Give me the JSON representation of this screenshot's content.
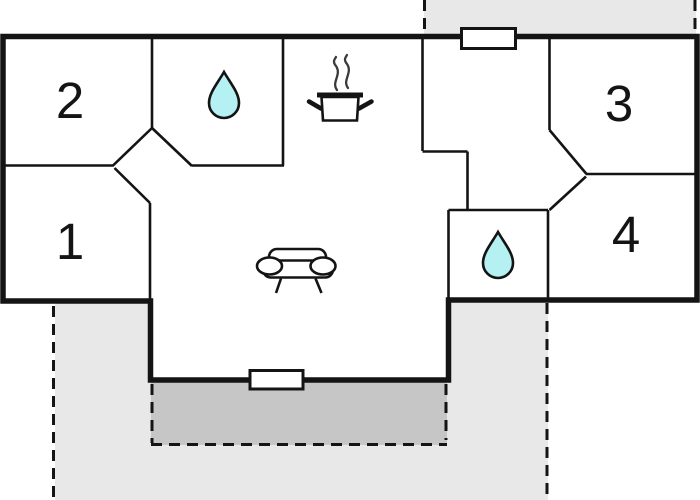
{
  "floor_plan": {
    "rooms": [
      {
        "label": "1"
      },
      {
        "label": "2"
      },
      {
        "label": "3"
      },
      {
        "label": "4"
      }
    ],
    "icons": {
      "bathroom_top": "water-drop-icon",
      "bathroom_bottom": "water-drop-icon",
      "kitchen": "cooking-pot-icon",
      "living_area": "sofa-icon",
      "wall_openings": "window-marker"
    },
    "colors": {
      "wall": "#141414",
      "terrace_light": "#e8e8e8",
      "terrace_dark": "#c6c6c6",
      "water": "#b5f0f2",
      "white": "#ffffff"
    }
  }
}
